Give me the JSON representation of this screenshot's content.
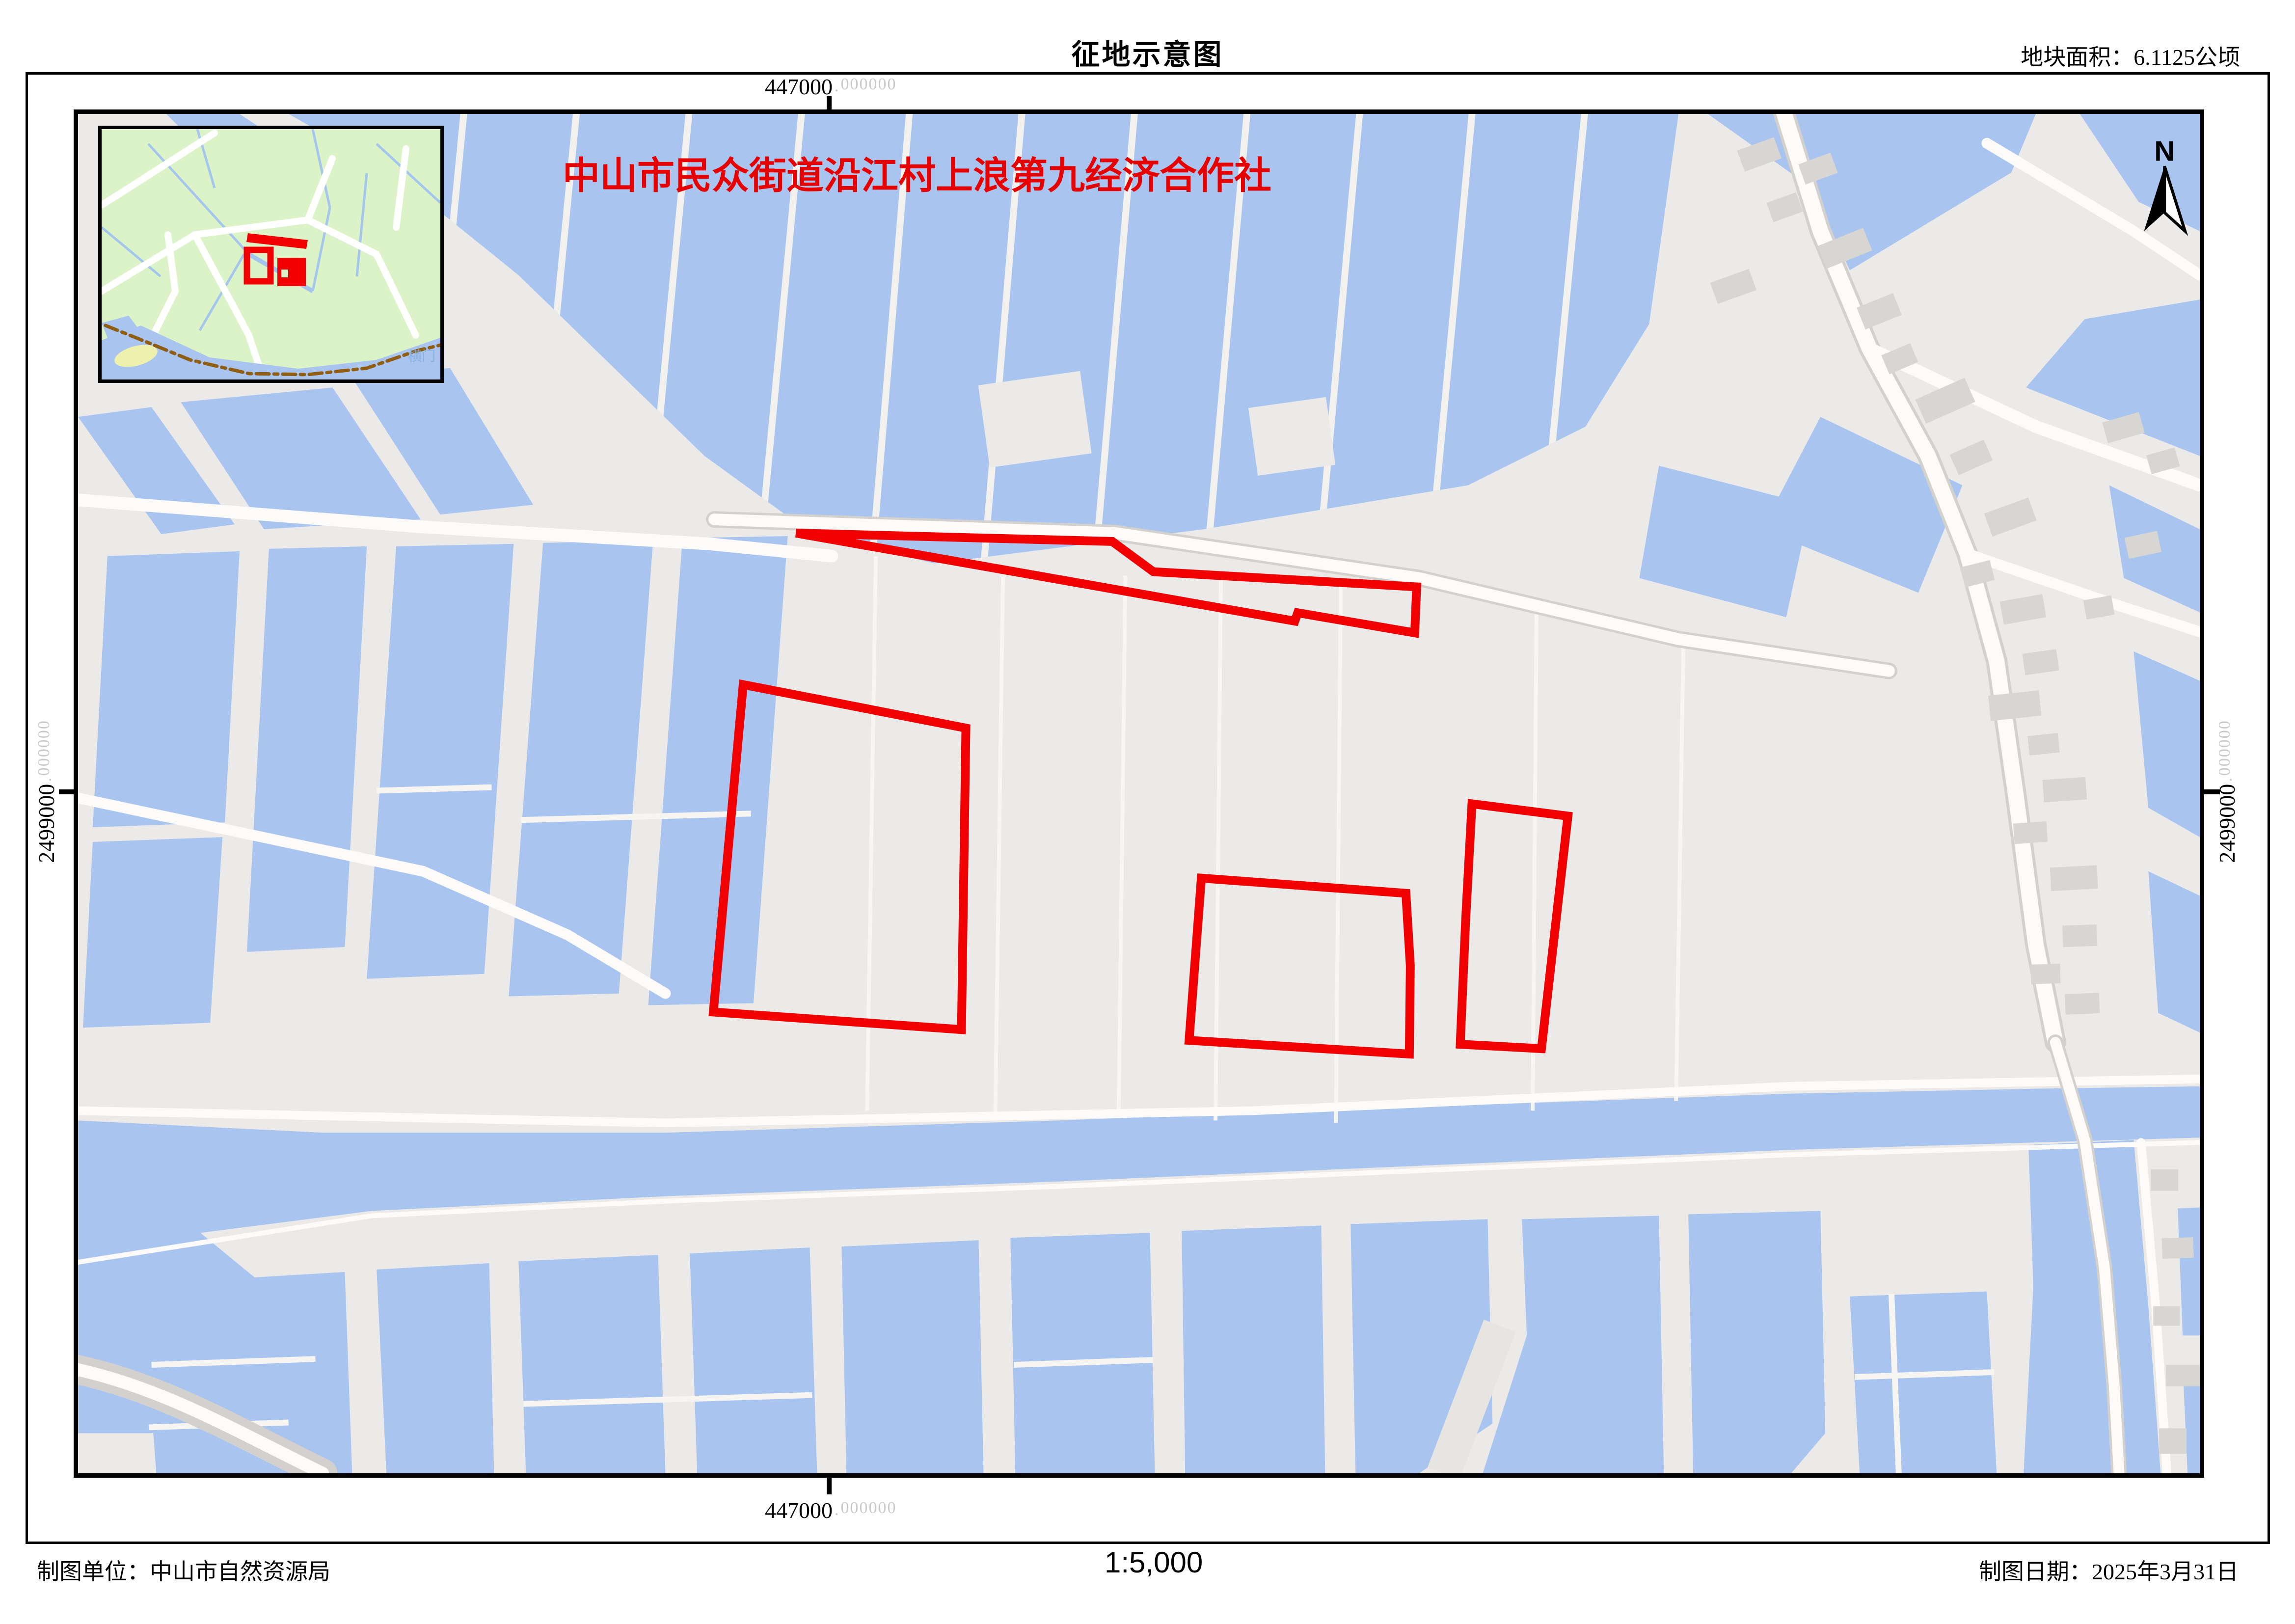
{
  "page": {
    "title": "征地示意图",
    "area_label": "地块面积：6.1125公顷",
    "owner_label": "中山市民众街道沿江村上浪第九经济合作社",
    "footer_left": "制图单位：中山市自然资源局",
    "scale_text": "1:5,000",
    "footer_right": "制图日期：2025年3月31日",
    "north_label": "N"
  },
  "coordinates": {
    "x_label": "447000",
    "x_suffix": "000000",
    "y_label": "2499000",
    "y_suffix": "000000"
  },
  "inset": {
    "water_label": "横门"
  },
  "colors": {
    "water": "#A9C4EF",
    "land": "#EBEAE8",
    "building": "#D7D6D3",
    "road": "#FCFBF9",
    "parcel_red": "#F00000",
    "inset_green": "#DBF3C6",
    "boundary_brown": "#8F5E12",
    "coord_suffix_grey": "#C9C9C9"
  },
  "parcels": [
    {
      "name": "parcel-sliver",
      "points": [
        [
          1467,
          858
        ],
        [
          2113,
          875
        ],
        [
          2197,
          937
        ],
        [
          2735,
          968
        ],
        [
          2731,
          1062
        ],
        [
          2492,
          1021
        ],
        [
          2486,
          1038
        ]
      ]
    },
    {
      "name": "parcel-west",
      "points": [
        [
          1359,
          1168
        ],
        [
          1814,
          1257
        ],
        [
          1805,
          1874
        ],
        [
          1298,
          1838
        ]
      ]
    },
    {
      "name": "parcel-middle",
      "points": [
        [
          2295,
          1564
        ],
        [
          2713,
          1595
        ],
        [
          2722,
          1744
        ],
        [
          2720,
          1924
        ],
        [
          2270,
          1896
        ]
      ]
    },
    {
      "name": "parcel-east",
      "points": [
        [
          2848,
          1412
        ],
        [
          3044,
          1437
        ],
        [
          2990,
          1913
        ],
        [
          2824,
          1904
        ],
        [
          2835,
          1651
        ]
      ]
    }
  ]
}
